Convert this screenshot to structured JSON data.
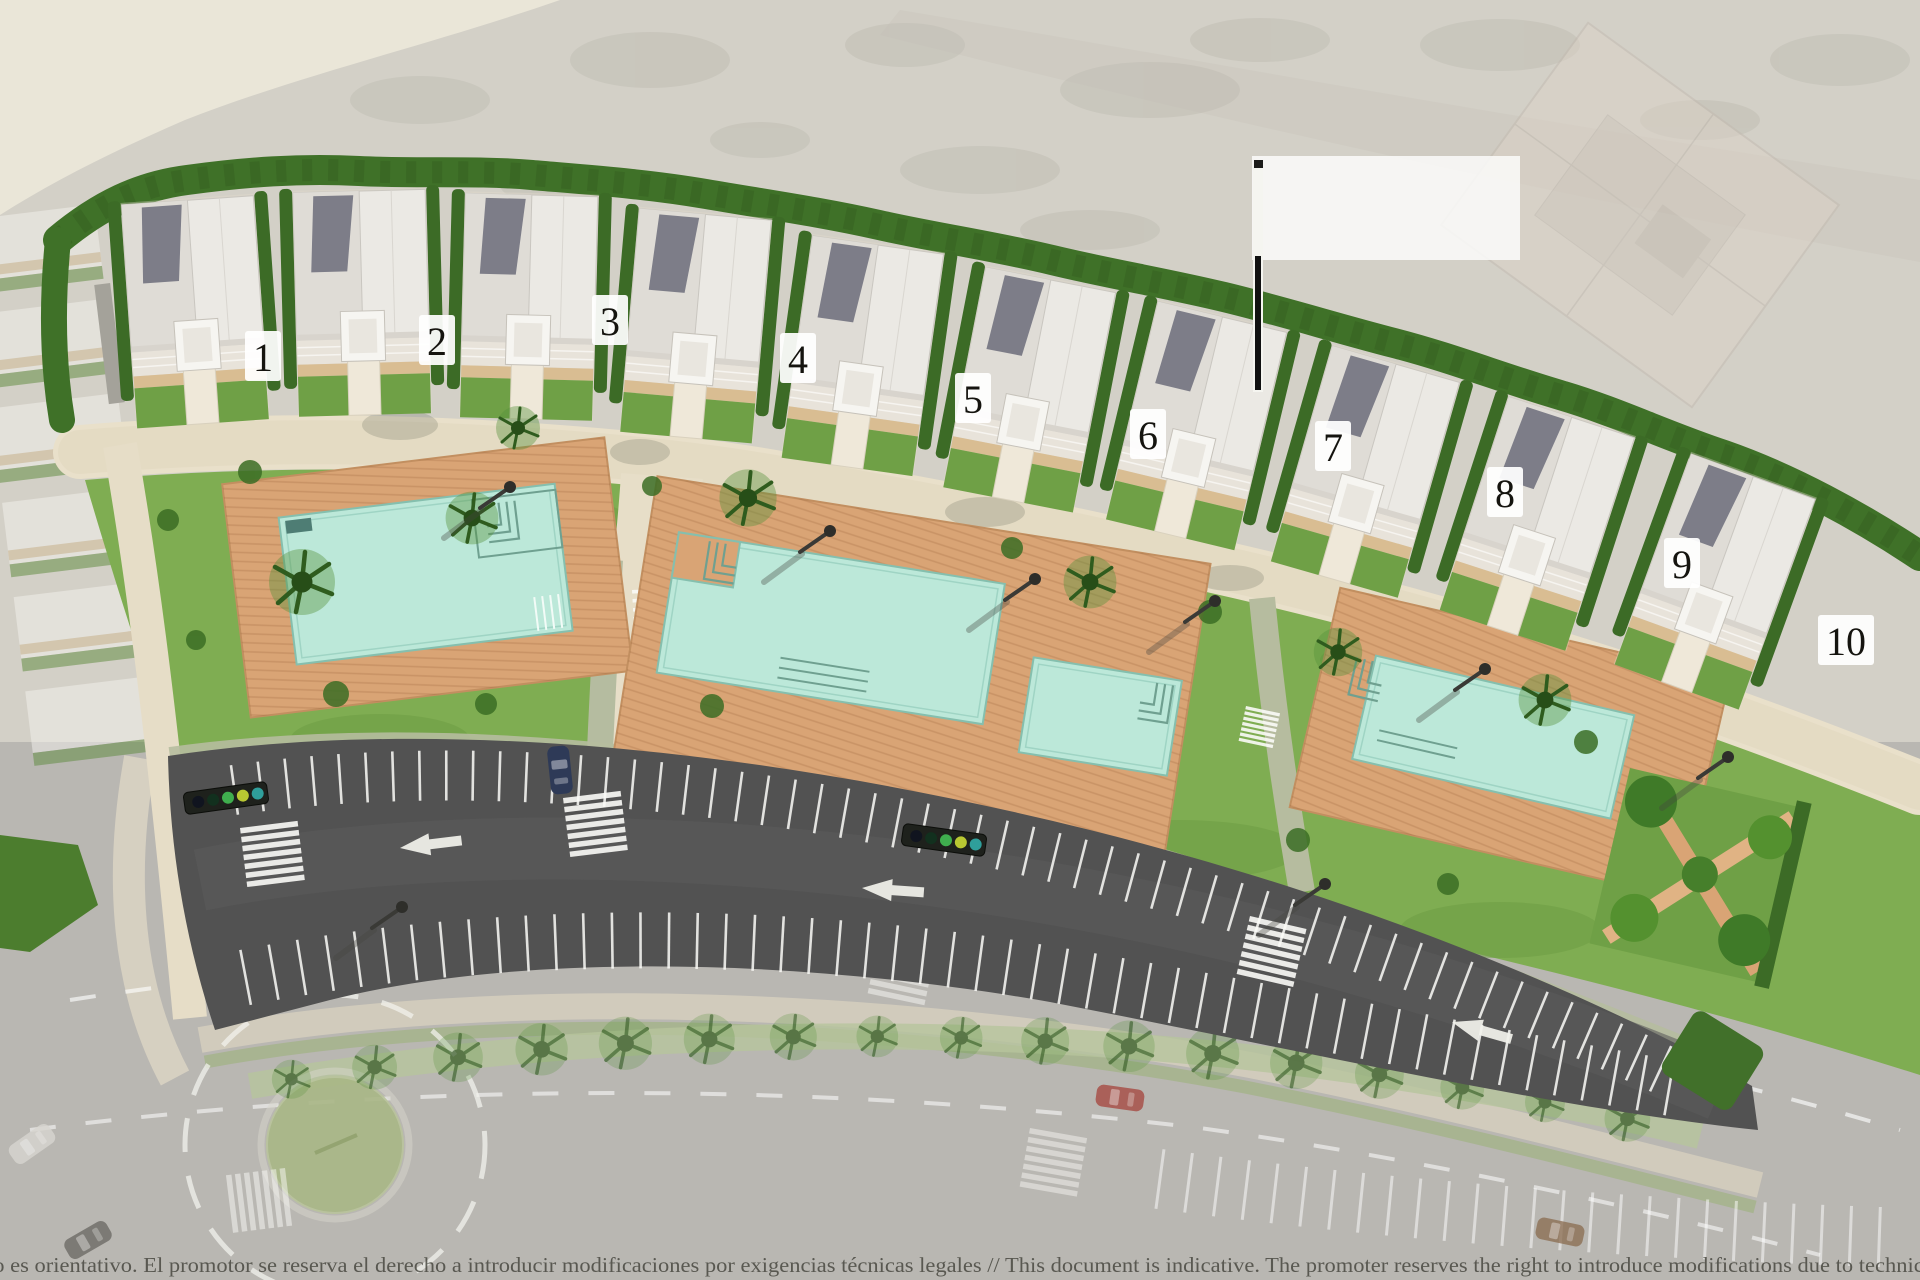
{
  "map": {
    "buildings": [
      {
        "label": "1"
      },
      {
        "label": "2"
      },
      {
        "label": "3"
      },
      {
        "label": "4"
      },
      {
        "label": "5"
      },
      {
        "label": "6"
      },
      {
        "label": "7"
      },
      {
        "label": "8"
      },
      {
        "label": "9"
      },
      {
        "label": "10"
      }
    ],
    "callout": {
      "label": ""
    },
    "disclaimer": "no es orientativo. El promotor se reserva el derecho a introducir modificaciones por exigencias técnicas legales  //  This document is indicative. The promoter reserves the right to introduce modifications due to technical",
    "colors": {
      "lawn": "#7fad52",
      "hedge": "#3f7128",
      "pool_water": "#bce8d9",
      "deck_wood": "#d9a475",
      "promenade": "#e9e0ca",
      "asphalt": "#525252",
      "road_faded": "#b9b7b2",
      "marking_white": "#fafaf8",
      "building": "#ebe9e4",
      "solar_panel": "#7d7d88"
    }
  }
}
